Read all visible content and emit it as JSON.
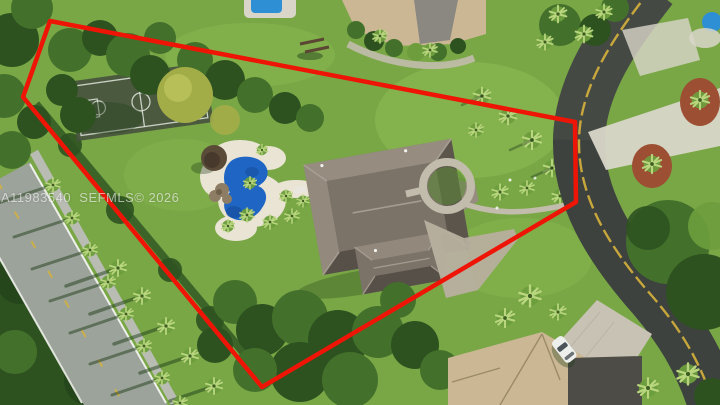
{
  "meta": {
    "kind": "real-estate-aerial-photo",
    "width": 720,
    "height": 405
  },
  "watermark": {
    "listing_id": "A11983540",
    "source": "SEFMLS",
    "copyright_year": "2026",
    "text": "A11983540  SEFMLS© 2026"
  },
  "property_outline": {
    "color": "#ee1507",
    "stroke_width": 4.5,
    "points": "50,21 575,122 576,202 262,387 23,97"
  },
  "features": [
    "main-house-hip-roof",
    "freeform-swimming-pool",
    "pool-deck",
    "tiki-hut",
    "rock-waterfall",
    "basketball-court",
    "circular-courtyard",
    "driveway",
    "front-walkway",
    "left-road",
    "sidewalk",
    "street-palm-trees",
    "curved-road-right",
    "double-yellow-center-line",
    "neighbor-house-north",
    "neighbor-pool",
    "playground",
    "neighbor-house-south",
    "paver-driveway",
    "parked-car",
    "red-mulch-beds",
    "tree-canopy",
    "boundary-hedge"
  ],
  "colors": {
    "lawn": "#79a746",
    "lawn-bright": "#93c257",
    "lawn-shade": "#5b8a37",
    "canopy": "#43712b",
    "canopy-dark": "#2d5220",
    "canopy-light": "#6d9d3d",
    "canopy-yellow": "#a3ad48",
    "frond": "#b9d67f",
    "shadow": "#1f3d18",
    "boundary-red": "#ee1507",
    "road-left": "#9ca39b",
    "road-right": "#3d423e",
    "road-line-yellow": "#d6b23c",
    "road-line-white": "#eef0ea",
    "sidewalk": "#b8bcb2",
    "pool-deck": "#eae4d4",
    "pool-water": "#1f66c4",
    "pool-water-dark": "#174f9e",
    "tiki": "#5a4a38",
    "rocks": "#8d7d64",
    "roof-light": "#968d80",
    "roof-mid": "#7b7368",
    "roof-dark": "#565048",
    "roof-ridge": "#aaa196",
    "driveway": "#b7af9e",
    "pathway": "#c2bcac",
    "neighbor-roof-tan": "#cbb794",
    "neighbor-roof-dark": "#4e4c47",
    "pavers": "#c8c2b4",
    "concrete": "#d9d6c9",
    "mulch": "#9c4f33",
    "court": "#49543f",
    "court-line": "#dfe5dc",
    "car-white": "#ecefec",
    "neighbor-pool": "#2f8fd4",
    "watermark-color": "rgba(255,255,255,0.60)"
  }
}
